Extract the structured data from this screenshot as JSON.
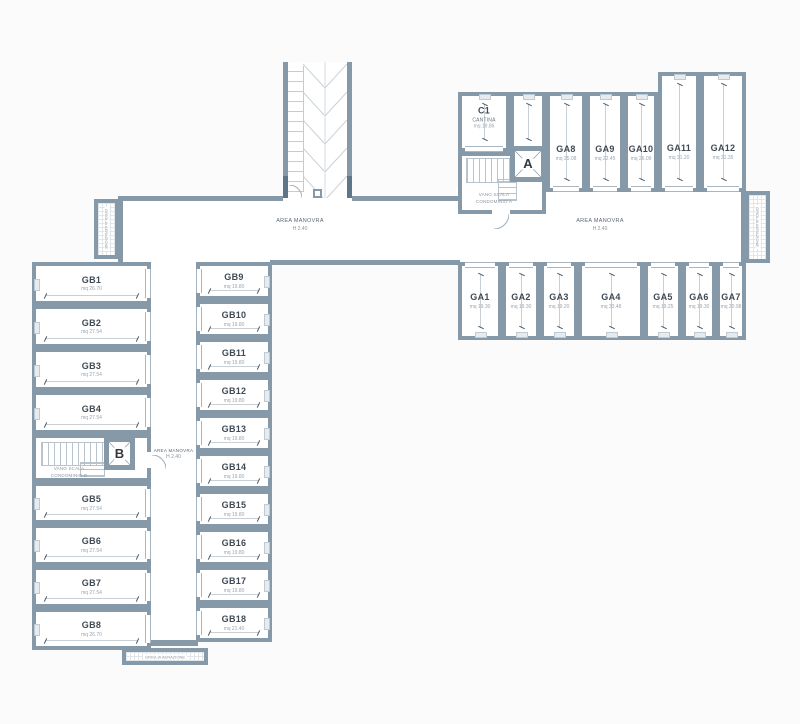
{
  "colors": {
    "wall": "#8599a9",
    "wall_dark": "#5f7689",
    "room_fill": "#ffffff",
    "background": "#fbfbfb",
    "dim_line": "#c8d0d6",
    "text_dark": "#3f4a54",
    "text_muted": "#9aa5ae"
  },
  "corridor_label": {
    "line1": "AREA MANOVRA",
    "line2": "H 2.40"
  },
  "stairwell_a": {
    "letter": "A",
    "line1": "VANO SCALA",
    "line2": "CONDOMINIO A"
  },
  "stairwell_b": {
    "letter": "B",
    "line1": "VANO SCALA",
    "line2": "CONDOMINIO B"
  },
  "grille_label": "GRIGLIA AERAZIONE",
  "rooms": [
    {
      "id": "GB1",
      "area": "mq 26.70",
      "x": 32,
      "y": 262,
      "w": 119,
      "h": 43,
      "door": "right"
    },
    {
      "id": "GB2",
      "area": "mq 27.54",
      "x": 32,
      "y": 305,
      "w": 119,
      "h": 43,
      "door": "right"
    },
    {
      "id": "GB3",
      "area": "mq 27.54",
      "x": 32,
      "y": 348,
      "w": 119,
      "h": 43,
      "door": "right"
    },
    {
      "id": "GB4",
      "area": "mq 27.54",
      "x": 32,
      "y": 391,
      "w": 119,
      "h": 43,
      "door": "right"
    },
    {
      "id": "GB5",
      "area": "mq 27.54",
      "x": 32,
      "y": 482,
      "w": 119,
      "h": 42,
      "door": "right"
    },
    {
      "id": "GB6",
      "area": "mq 27.54",
      "x": 32,
      "y": 524,
      "w": 119,
      "h": 42,
      "door": "right"
    },
    {
      "id": "GB7",
      "area": "mq 27.54",
      "x": 32,
      "y": 566,
      "w": 119,
      "h": 42,
      "door": "right"
    },
    {
      "id": "GB8",
      "area": "mq 26.70",
      "x": 32,
      "y": 608,
      "w": 119,
      "h": 42,
      "door": "right"
    },
    {
      "id": "GB9",
      "area": "mq 19.80",
      "x": 196,
      "y": 262,
      "w": 76,
      "h": 38,
      "door": "left"
    },
    {
      "id": "GB10",
      "area": "mq 19.80",
      "x": 196,
      "y": 300,
      "w": 76,
      "h": 38,
      "door": "left"
    },
    {
      "id": "GB11",
      "area": "mq 19.80",
      "x": 196,
      "y": 338,
      "w": 76,
      "h": 38,
      "door": "left"
    },
    {
      "id": "GB12",
      "area": "mq 19.80",
      "x": 196,
      "y": 376,
      "w": 76,
      "h": 38,
      "door": "left"
    },
    {
      "id": "GB13",
      "area": "mq 19.80",
      "x": 196,
      "y": 414,
      "w": 76,
      "h": 38,
      "door": "left"
    },
    {
      "id": "GB14",
      "area": "mq 19.80",
      "x": 196,
      "y": 452,
      "w": 76,
      "h": 38,
      "door": "left"
    },
    {
      "id": "GB15",
      "area": "mq 19.80",
      "x": 196,
      "y": 490,
      "w": 76,
      "h": 38,
      "door": "left"
    },
    {
      "id": "GB16",
      "area": "mq 19.80",
      "x": 196,
      "y": 528,
      "w": 76,
      "h": 38,
      "door": "left"
    },
    {
      "id": "GB17",
      "area": "mq 19.80",
      "x": 196,
      "y": 566,
      "w": 76,
      "h": 38,
      "door": "left"
    },
    {
      "id": "GB18",
      "area": "mq 21.40",
      "x": 196,
      "y": 604,
      "w": 76,
      "h": 38,
      "door": "left"
    },
    {
      "id": "GA1",
      "area": "mq 19.30",
      "x": 458,
      "y": 262,
      "w": 44,
      "h": 78,
      "door": "top"
    },
    {
      "id": "GA2",
      "area": "mq 19.30",
      "x": 502,
      "y": 262,
      "w": 38,
      "h": 78,
      "door": "top"
    },
    {
      "id": "GA3",
      "area": "mq 19.20",
      "x": 540,
      "y": 262,
      "w": 38,
      "h": 78,
      "door": "top"
    },
    {
      "id": "GA4",
      "area": "mq 33.48",
      "x": 578,
      "y": 262,
      "w": 66,
      "h": 78,
      "door": "top"
    },
    {
      "id": "GA5",
      "area": "mq 19.25",
      "x": 644,
      "y": 262,
      "w": 38,
      "h": 78,
      "door": "top"
    },
    {
      "id": "GA6",
      "area": "mq 19.30",
      "x": 682,
      "y": 262,
      "w": 34,
      "h": 78,
      "door": "top"
    },
    {
      "id": "GA7",
      "area": "mq 20.98",
      "x": 716,
      "y": 262,
      "w": 30,
      "h": 78,
      "door": "top"
    },
    {
      "id": "GA8",
      "area": "mq 25.08",
      "x": 546,
      "y": 92,
      "w": 40,
      "h": 100,
      "door": "bottom",
      "ly": 62
    },
    {
      "id": "GA9",
      "area": "mq 22.45",
      "x": 586,
      "y": 92,
      "w": 38,
      "h": 100,
      "door": "bottom",
      "ly": 62
    },
    {
      "id": "GA10",
      "area": "mq 26.09",
      "x": 624,
      "y": 92,
      "w": 34,
      "h": 100,
      "door": "bottom",
      "ly": 62
    },
    {
      "id": "GA11",
      "area": "mq 31.20",
      "x": 658,
      "y": 72,
      "w": 42,
      "h": 120,
      "door": "bottom",
      "ly": 68
    },
    {
      "id": "GA12",
      "area": "mq 31.35",
      "x": 700,
      "y": 72,
      "w": 46,
      "h": 120,
      "door": "bottom",
      "ly": 68
    },
    {
      "id": "C1",
      "sub": "CANTINA",
      "area": "mq 19.86",
      "x": 458,
      "y": 92,
      "w": 52,
      "h": 60,
      "door": "bottom",
      "ly": 42
    },
    {
      "id": "",
      "area": "",
      "x": 510,
      "y": 92,
      "w": 36,
      "h": 60,
      "door": "bottom"
    }
  ]
}
